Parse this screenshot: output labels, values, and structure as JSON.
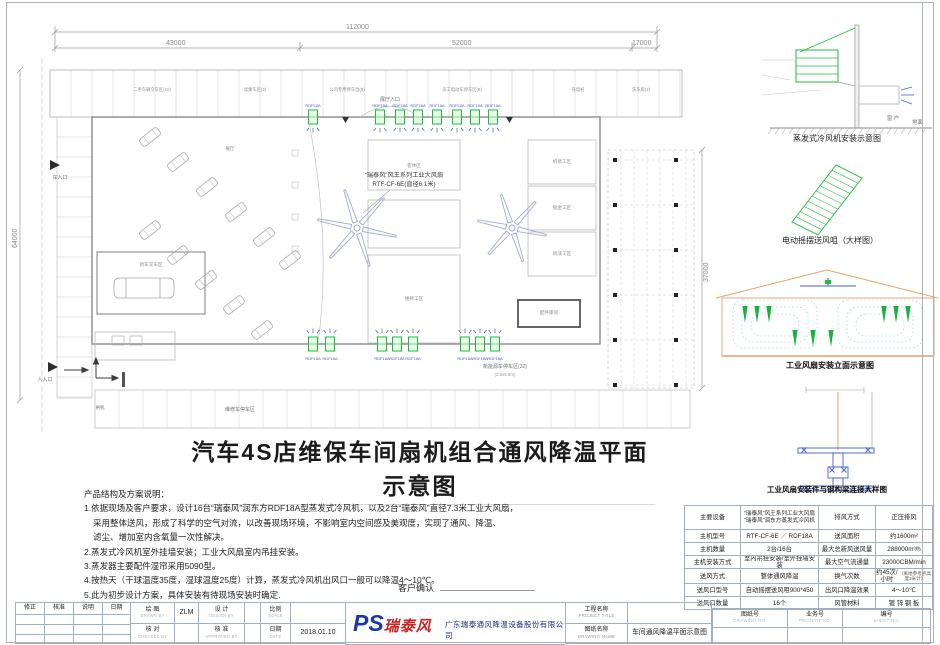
{
  "sheet": {
    "main_title": "汽车4S店维保车间扇机组合通风降温平面示意图",
    "customer_confirm": "客户确认"
  },
  "notes": {
    "heading": "产品结构及方案说明：",
    "lines": [
      "1.依据现场及客户要求，设计16台“瑞泰风”润东方RDF18A型蒸发式冷风机，以及2台“瑞泰风”直径7.3米工业大风扇，",
      "采用整体送风，形成了科学的空气对流，以改善现场环境，不影响室内空间感及美观度，实现了通风、降温、",
      "滤尘、增加室内含氧量一次性解决。",
      "2.蒸发式冷风机室外挂墙安装；工业大风扇室内吊挂安装。",
      "3.蒸发器主要配件湿帘采用5090型。",
      "4.按热天（干球温度35度，湿球温度25度）计算，蒸发式冷风机出风口一般可以降温4～10℃。",
      "5.此为初步设计方案，具体安装有待现场安装时确定."
    ]
  },
  "details": {
    "caption1": "蒸发式冷风机安装示意图",
    "caption2": "电动摇摆送风咀（大样图）",
    "caption3": "工业风扇安装立面示意图",
    "caption4": "工业风扇安装件与钢构梁连接大样图",
    "ground": "地面",
    "window": "窗 户"
  },
  "plan": {
    "dims": {
      "total": "112000",
      "d1": "43000",
      "d2": "52000",
      "d3": "17000",
      "left": "64000",
      "right": "37000"
    },
    "cooler_model": "RDF18A",
    "fan_callout_1": "“瑞泰风”风王系列工业大风扇",
    "fan_callout_2": "RTF-CF-6E(直径6.1米)",
    "entry_car": "车入口",
    "entry_person": "人入口",
    "entry_hall": "展厅入口",
    "gate": "闸机",
    "parking_bottom": "维修车停车区",
    "parking_new_energy": "新能源车停车区(32)",
    "parking_size": "(2.5x5.5m)",
    "top_band_labels": [
      {
        "x": 152,
        "t": "二手车辆交车区(10)"
      },
      {
        "x": 255,
        "t": "试乘车区(2)"
      },
      {
        "x": 347,
        "t": "公司专用停车位(8)"
      },
      {
        "x": 462,
        "t": "员工电动车停车区(8)"
      },
      {
        "x": 578,
        "t": "充电桩"
      },
      {
        "x": 641,
        "t": "洗车房(2)"
      }
    ],
    "room_labels": [
      {
        "x": 230,
        "y": 150,
        "t": "展厅"
      },
      {
        "x": 414,
        "y": 167,
        "t": "客休区"
      },
      {
        "x": 414,
        "y": 300,
        "t": "维修工区"
      },
      {
        "x": 562,
        "y": 163,
        "t": "机修工区"
      },
      {
        "x": 562,
        "y": 209,
        "t": "钣金工区"
      },
      {
        "x": 562,
        "y": 255,
        "t": "喷漆工区"
      },
      {
        "x": 549,
        "y": 314,
        "t": "配件库房"
      },
      {
        "x": 151,
        "y": 266,
        "t": "新车交车区"
      }
    ],
    "coolers_top": [
      313,
      380,
      400,
      418,
      437,
      457,
      475,
      493
    ],
    "coolers_bottom": [
      313,
      330,
      382,
      397,
      413,
      465,
      480,
      495
    ],
    "fans": [
      {
        "x": 357,
        "y": 228,
        "r": 40
      },
      {
        "x": 512,
        "y": 228,
        "r": 35
      }
    ],
    "cars": [
      {
        "x": 150,
        "y": 137
      },
      {
        "x": 178,
        "y": 162
      },
      {
        "x": 207,
        "y": 187
      },
      {
        "x": 236,
        "y": 212
      },
      {
        "x": 264,
        "y": 237
      },
      {
        "x": 290,
        "y": 260
      },
      {
        "x": 150,
        "y": 230
      },
      {
        "x": 178,
        "y": 255
      },
      {
        "x": 206,
        "y": 280
      },
      {
        "x": 234,
        "y": 305
      },
      {
        "x": 262,
        "y": 330
      }
    ]
  },
  "spec_table": {
    "rows": [
      {
        "l1": "主要设备",
        "v1": "“瑞泰风”风王系列工业大风扇\n“瑞泰风”润东方蒸发式冷风机",
        "l2": "排风方式",
        "v2": "正压排风"
      },
      {
        "l1": "主机型号",
        "v1": "RTF-CF-6E ／ RDF18A",
        "l2": "送风面积",
        "v2": "约1600m²"
      },
      {
        "l1": "主机数量",
        "v1": "2台/16台",
        "l2": "最大总新风送风量",
        "v2": "288000m³/h"
      },
      {
        "l1": "主机安装方式",
        "v1": "室内吊挂安装/室外挂墙安装",
        "l2": "最大空气流通量",
        "v2": "23000CBM/min"
      },
      {
        "l1": "送风方式",
        "v1": "整体通风降温",
        "l2": "换气次数",
        "v2": "约45次/小时",
        "v2sub": "（离地参考点高度3米计）"
      },
      {
        "l1": "送风口型号",
        "v1": "自动摇摆送风咀900*450",
        "l2": "出风口降温效果",
        "v2": "4～10℃"
      },
      {
        "l1": "送风口数量",
        "v1": "16个",
        "l2": "风管材料",
        "v2": "镀 锌 钢 板"
      }
    ]
  },
  "title_block": {
    "rev_headers": [
      "修正",
      "核准",
      "说明",
      "日期"
    ],
    "drawn_cn": "绘 图",
    "drawn_en": "DRAWN BY",
    "drawn_val": "ZLM",
    "design_cn": "设 计",
    "design_en": "DESIGN BY",
    "design_val": "",
    "checked_cn": "核 对",
    "checked_en": "CHECKED BY",
    "checked_val": "",
    "approved_cn": "核 准",
    "approved_en": "APPROVED BY",
    "approved_val": "",
    "scale_cn": "比例",
    "scale_en": "SCALE",
    "scale_val": "",
    "date_cn": "日期",
    "date_en": "DATE",
    "date_val": "2018.01.10",
    "logo_ps": "PS",
    "logo_name": "瑞泰风",
    "company": "广东瑞泰通风降温设备股份有限公司",
    "project_cn": "工程名称",
    "project_en": "PROJECT TITLE",
    "project_val": "",
    "dname_cn": "图纸名称",
    "dname_en": "DRAWING NAME",
    "dname_val": "车间通风降温平面示意图",
    "dno_cn": "图纸号",
    "dno_en": "DRAWING NO.",
    "pno_cn": "业务号",
    "pno_en": "PROJECT NO.",
    "sno_cn": "编号",
    "sno_en": "SHEET NO."
  },
  "colors": {
    "green": "#1fbb3c",
    "blue": "#3f5fd0",
    "cyan": "#8fd8e8",
    "orange": "#e6a269",
    "fan": "#a0a8d8",
    "line": "#b4b4b4",
    "wall": "#8a8a8a",
    "logo_red": "#cc2222",
    "logo_blue": "#163ba6"
  }
}
